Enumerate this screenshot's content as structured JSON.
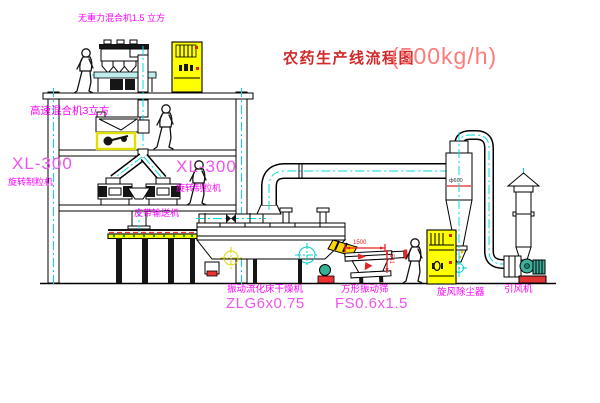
{
  "title": {
    "main": "农药生产线流程图",
    "capacity": "(500kg/h)"
  },
  "equipment": {
    "gravity_mixer": {
      "label": "无重力混合机1.5 立方"
    },
    "high_speed_mixer": {
      "label": "高速混合机3立方"
    },
    "granulator_left": {
      "model": "XL-300",
      "name": "旋转制粒机"
    },
    "granulator_right": {
      "model": "XL-300",
      "name": "旋转制粒机"
    },
    "belt_conveyor": {
      "label": "皮带输送机"
    },
    "dryer": {
      "name": "振动流化床干燥机",
      "model": "ZLG6x0.75"
    },
    "sieve": {
      "name": "方形振动筛",
      "model": "FS0.6x1.5"
    },
    "cyclone": {
      "label": "旋风除尘器"
    },
    "fan": {
      "label": "引风机"
    }
  },
  "dimensions": {
    "sieve_length": "1500",
    "sieve_height": "541",
    "cyclone_note": "ф600"
  },
  "colors": {
    "label_magenta": "#ff00ff",
    "title_red": "#cf2a2a",
    "capacity_red": "#ff7a7a",
    "centerline_cyan": "#00dcdc",
    "cad_yellow": "#ffff00",
    "dimension_red": "#e62222",
    "dot_green": "#00a800"
  }
}
